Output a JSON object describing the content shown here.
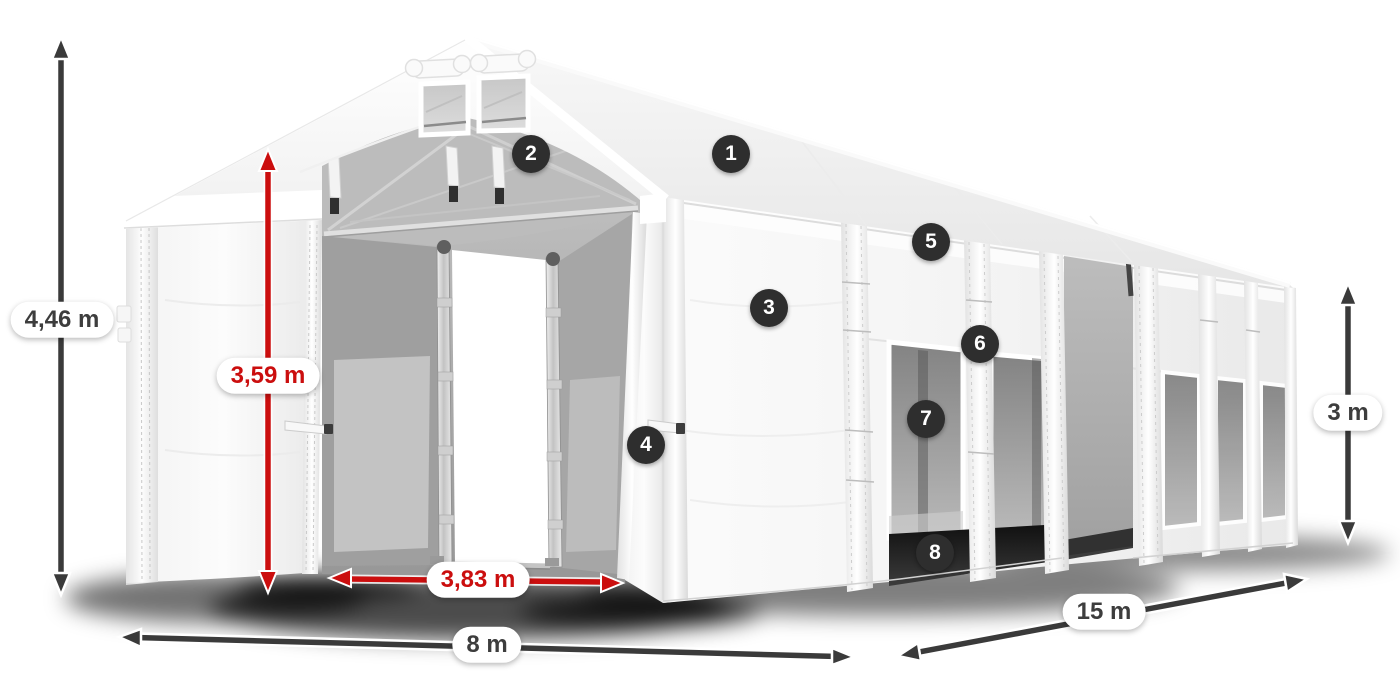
{
  "scene": {
    "description": "White 8x15 m storage marquee tent with dimension arrows and numbered feature callouts",
    "background": "#ffffff"
  },
  "dimensions": {
    "total_height": {
      "label": "4,46 m",
      "style": "dark"
    },
    "door_height": {
      "label": "3,59 m",
      "style": "red"
    },
    "door_width": {
      "label": "3,83 m",
      "style": "red"
    },
    "front_width": {
      "label": "8 m",
      "style": "dark"
    },
    "side_length": {
      "label": "15 m",
      "style": "dark"
    },
    "side_height": {
      "label": "3 m",
      "style": "dark"
    }
  },
  "callouts": [
    "1",
    "2",
    "3",
    "4",
    "5",
    "6",
    "7",
    "8"
  ],
  "colors": {
    "arrow_dark": "#3a3a3a",
    "arrow_red": "#cb0e0e",
    "label_text_dark": "#3d3d3d",
    "label_text_red": "#cb0e0e",
    "label_background": "#ffffff",
    "badge_background": "#2e2e2e",
    "badge_text": "#ffffff"
  }
}
